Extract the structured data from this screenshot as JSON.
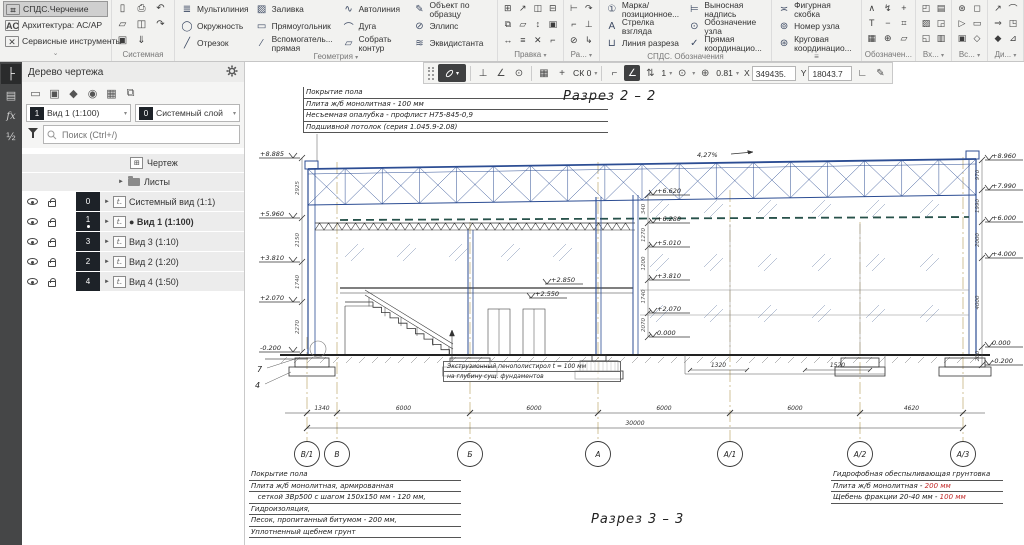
{
  "ribbon": {
    "workspaces": [
      {
        "label": "СПДС.Черчение",
        "glyph": "⌗",
        "active": true
      },
      {
        "label": "Архитектура: АС/АР",
        "glyph": "AC",
        "active": false
      },
      {
        "label": "Сервисные инструменты",
        "glyph": "✕",
        "active": false
      }
    ],
    "system": {
      "label": "Системная",
      "icons": [
        {
          "name": "new-document",
          "glyph": "▯"
        },
        {
          "name": "open-document",
          "glyph": "▱"
        },
        {
          "name": "save",
          "glyph": "▣"
        },
        {
          "name": "print",
          "glyph": "⎙"
        },
        {
          "name": "print-preview",
          "glyph": "◫"
        },
        {
          "name": "save-as",
          "glyph": "⇓"
        },
        {
          "name": "undo",
          "glyph": "↶"
        },
        {
          "name": "redo",
          "glyph": "↷"
        }
      ]
    },
    "geometry": {
      "label": "Геометрия",
      "tools": [
        {
          "name": "multiline",
          "glyph": "≣",
          "label": "Мультилиния"
        },
        {
          "name": "circle",
          "glyph": "◯",
          "label": "Окружность"
        },
        {
          "name": "segment",
          "glyph": "╱",
          "label": "Отрезок"
        },
        {
          "name": "fill",
          "glyph": "▨",
          "label": "Заливка"
        },
        {
          "name": "rectangle",
          "glyph": "▭",
          "label": "Прямоугольник"
        },
        {
          "name": "construction-line",
          "glyph": "∕",
          "label": "Вспомогатель... прямая"
        },
        {
          "name": "autoline",
          "glyph": "∿",
          "label": "Автолиния"
        },
        {
          "name": "arc",
          "glyph": "⌒",
          "label": "Дуга"
        },
        {
          "name": "collect-contour",
          "glyph": "▱",
          "label": "Собрать контур"
        },
        {
          "name": "object-by-sample",
          "glyph": "✎",
          "label": "Объект по образцу"
        },
        {
          "name": "ellipse",
          "glyph": "⊘",
          "label": "Эллипс"
        },
        {
          "name": "equidistant",
          "glyph": "≋",
          "label": "Эквидистанта"
        }
      ]
    },
    "edit": {
      "label": "Правка",
      "icons": [
        "⊞",
        "⧉",
        "↔",
        "↗",
        "▱",
        "≡",
        "◫",
        "↕",
        "✕",
        "⊟",
        "▣",
        "⌐"
      ]
    },
    "razmery": {
      "label": "Ра...",
      "icons": [
        "⊢",
        "⌐",
        "⊘",
        "↷",
        "⊥",
        "↳"
      ]
    },
    "spds": {
      "label": "СПДС. Обозначения",
      "tools": [
        {
          "name": "position-mark",
          "glyph": "①",
          "label": "Марка/ позиционное..."
        },
        {
          "name": "view-arrow",
          "glyph": "A",
          "label": "Стрелка взгляда"
        },
        {
          "name": "section-line",
          "glyph": "⊔",
          "label": "Линия разреза"
        },
        {
          "name": "leader-note",
          "glyph": "⊨",
          "label": "Выносная надпись"
        },
        {
          "name": "node-designation",
          "glyph": "⊙",
          "label": "Обозначение узла"
        },
        {
          "name": "direct-coordination",
          "glyph": "✓",
          "label": "Прямая координацио..."
        }
      ]
    },
    "extra": {
      "tools": [
        {
          "name": "curly-bracket",
          "glyph": "≍",
          "label": "Фигурная скобка"
        },
        {
          "name": "node-number",
          "glyph": "⊚",
          "label": "Номер узла"
        },
        {
          "name": "circular-coordination",
          "glyph": "⊛",
          "label": "Круговая координацио..."
        }
      ]
    },
    "trailing": [
      {
        "label": "Обозначен...",
        "icons": [
          "∧",
          "T",
          "▦",
          "↯",
          "−",
          "⊕",
          "+",
          "⌗",
          "▱"
        ]
      },
      {
        "label": "Вх...",
        "icons": [
          "◰",
          "▨",
          "◱",
          "▤",
          "◲",
          "▥"
        ]
      },
      {
        "label": "Вс...",
        "icons": [
          "⊛",
          "▷",
          "▣",
          "◻",
          "▭",
          "◇"
        ]
      },
      {
        "label": "Ди...",
        "icons": [
          "↗",
          "⇒",
          "◆",
          "⌒",
          "◳",
          "⊿"
        ]
      }
    ]
  },
  "quickbar": {
    "cs_value": "СК 0",
    "layer_value": "1",
    "zoom_value": "0.81",
    "x_label": "X",
    "x_value": "349435.",
    "y_label": "Y",
    "y_value": "18043.7"
  },
  "tree": {
    "title": "Дерево чертежа",
    "view_combo": {
      "badge": "1",
      "value": "Вид 1 (1:100)"
    },
    "layer_combo": {
      "badge": "0",
      "value": "Системный слой"
    },
    "search_placeholder": "Поиск (Ctrl+/)",
    "roots": [
      {
        "label": "Чертеж"
      },
      {
        "label": "Листы"
      }
    ],
    "views": [
      {
        "num": "0",
        "label": "Системный вид (1:1)",
        "active": false
      },
      {
        "num": "1",
        "label": "● Вид 1 (1:100)",
        "active": true
      },
      {
        "num": "3",
        "label": "Вид 3 (1:10)",
        "active": false
      },
      {
        "num": "2",
        "label": "Вид 2 (1:20)",
        "active": false
      },
      {
        "num": "4",
        "label": "Вид 4 (1:50)",
        "active": false
      }
    ]
  },
  "drawing": {
    "title_top": "Разрез 2 – 2",
    "title_bottom": "Разрез 3 – 3",
    "slope": "4,27%",
    "top_callout": [
      "Покрытие пола",
      "Плита ж/б монолитная - 100 мм",
      "Несъемная опалубка - профлист Н75-845-0,9",
      "Подшивной потолок (серия 1.045.9-2.08)"
    ],
    "bottom_left_callout": [
      "Покрытие пола",
      "Плита ж/б монолитная, армированная",
      "   сеткой 3Вр500 с шагом 150х150 мм - 120 мм,",
      "Гидроизоляция,",
      "Песок, пропитанный битумом - 200 мм,",
      "Уплотненный щебнем грунт"
    ],
    "bottom_right_callout": [
      {
        "text": "Гидрофобная обеспыливающая грунтовка",
        "red": ""
      },
      {
        "text": "Плита ж/б монолитная - ",
        "red": "200 мм"
      },
      {
        "text": "Щебень фракции 20-40 мм - ",
        "red": "100 мм"
      }
    ],
    "insulation_note": [
      "Экструзионный пенополистирол t = 100 мм",
      "на глубину сущ. фундаментов"
    ],
    "axes": [
      {
        "label": "В/1",
        "x": 62,
        "top": 275
      },
      {
        "label": "В",
        "x": 92,
        "top": 100
      },
      {
        "label": "Б",
        "x": 225,
        "top": 160
      },
      {
        "label": "А",
        "x": 353,
        "top": 100
      },
      {
        "label": "А/1",
        "x": 485,
        "top": 128
      },
      {
        "label": "А/2",
        "x": 615,
        "top": 160
      },
      {
        "label": "А/3",
        "x": 718,
        "top": 95
      }
    ],
    "dims": [
      "1340",
      "6000",
      "6000",
      "6000",
      "6000",
      "4620"
    ],
    "total_dim": "30000",
    "sub_dims": [
      {
        "text": "1320",
        "x1": 445,
        "x2": 502
      },
      {
        "text": "1520",
        "x1": 560,
        "x2": 625
      }
    ],
    "elev_left": [
      {
        "v": "+8.885",
        "y": 96
      },
      {
        "v": "+5.960",
        "y": 156
      },
      {
        "v": "+3.810",
        "y": 200
      },
      {
        "v": "+2.070",
        "y": 240
      },
      {
        "v": "-0.200",
        "y": 290
      }
    ],
    "chain_left": [
      "2925",
      "2150",
      "1740",
      "2270"
    ],
    "elev_right": [
      {
        "v": "+8.960",
        "y": 98
      },
      {
        "v": "+7.990",
        "y": 128
      },
      {
        "v": "+6.000",
        "y": 160
      },
      {
        "v": "+4.000",
        "y": 196
      },
      {
        "v": "0.000",
        "y": 285
      },
      {
        "v": "-0.200",
        "y": 303
      }
    ],
    "chain_right": [
      "970",
      "1990",
      "2000",
      "4000",
      "200"
    ],
    "elev_mid": [
      {
        "v": "+6.620",
        "y": 133
      },
      {
        "v": "+6.280",
        "y": 161
      },
      {
        "v": "+5.010",
        "y": 185
      },
      {
        "v": "+3.810",
        "y": 218
      },
      {
        "v": "+2.070",
        "y": 251
      },
      {
        "v": "0.000",
        "y": 275
      }
    ],
    "chain_mid": [
      "340",
      "1270",
      "1200",
      "1740",
      "2070"
    ],
    "floor_marks": [
      {
        "v": "+2.850",
        "x": 302,
        "y": 214
      },
      {
        "v": "+2.550",
        "x": 286,
        "y": 228
      }
    ],
    "detail_markers": [
      "7",
      "4"
    ]
  }
}
